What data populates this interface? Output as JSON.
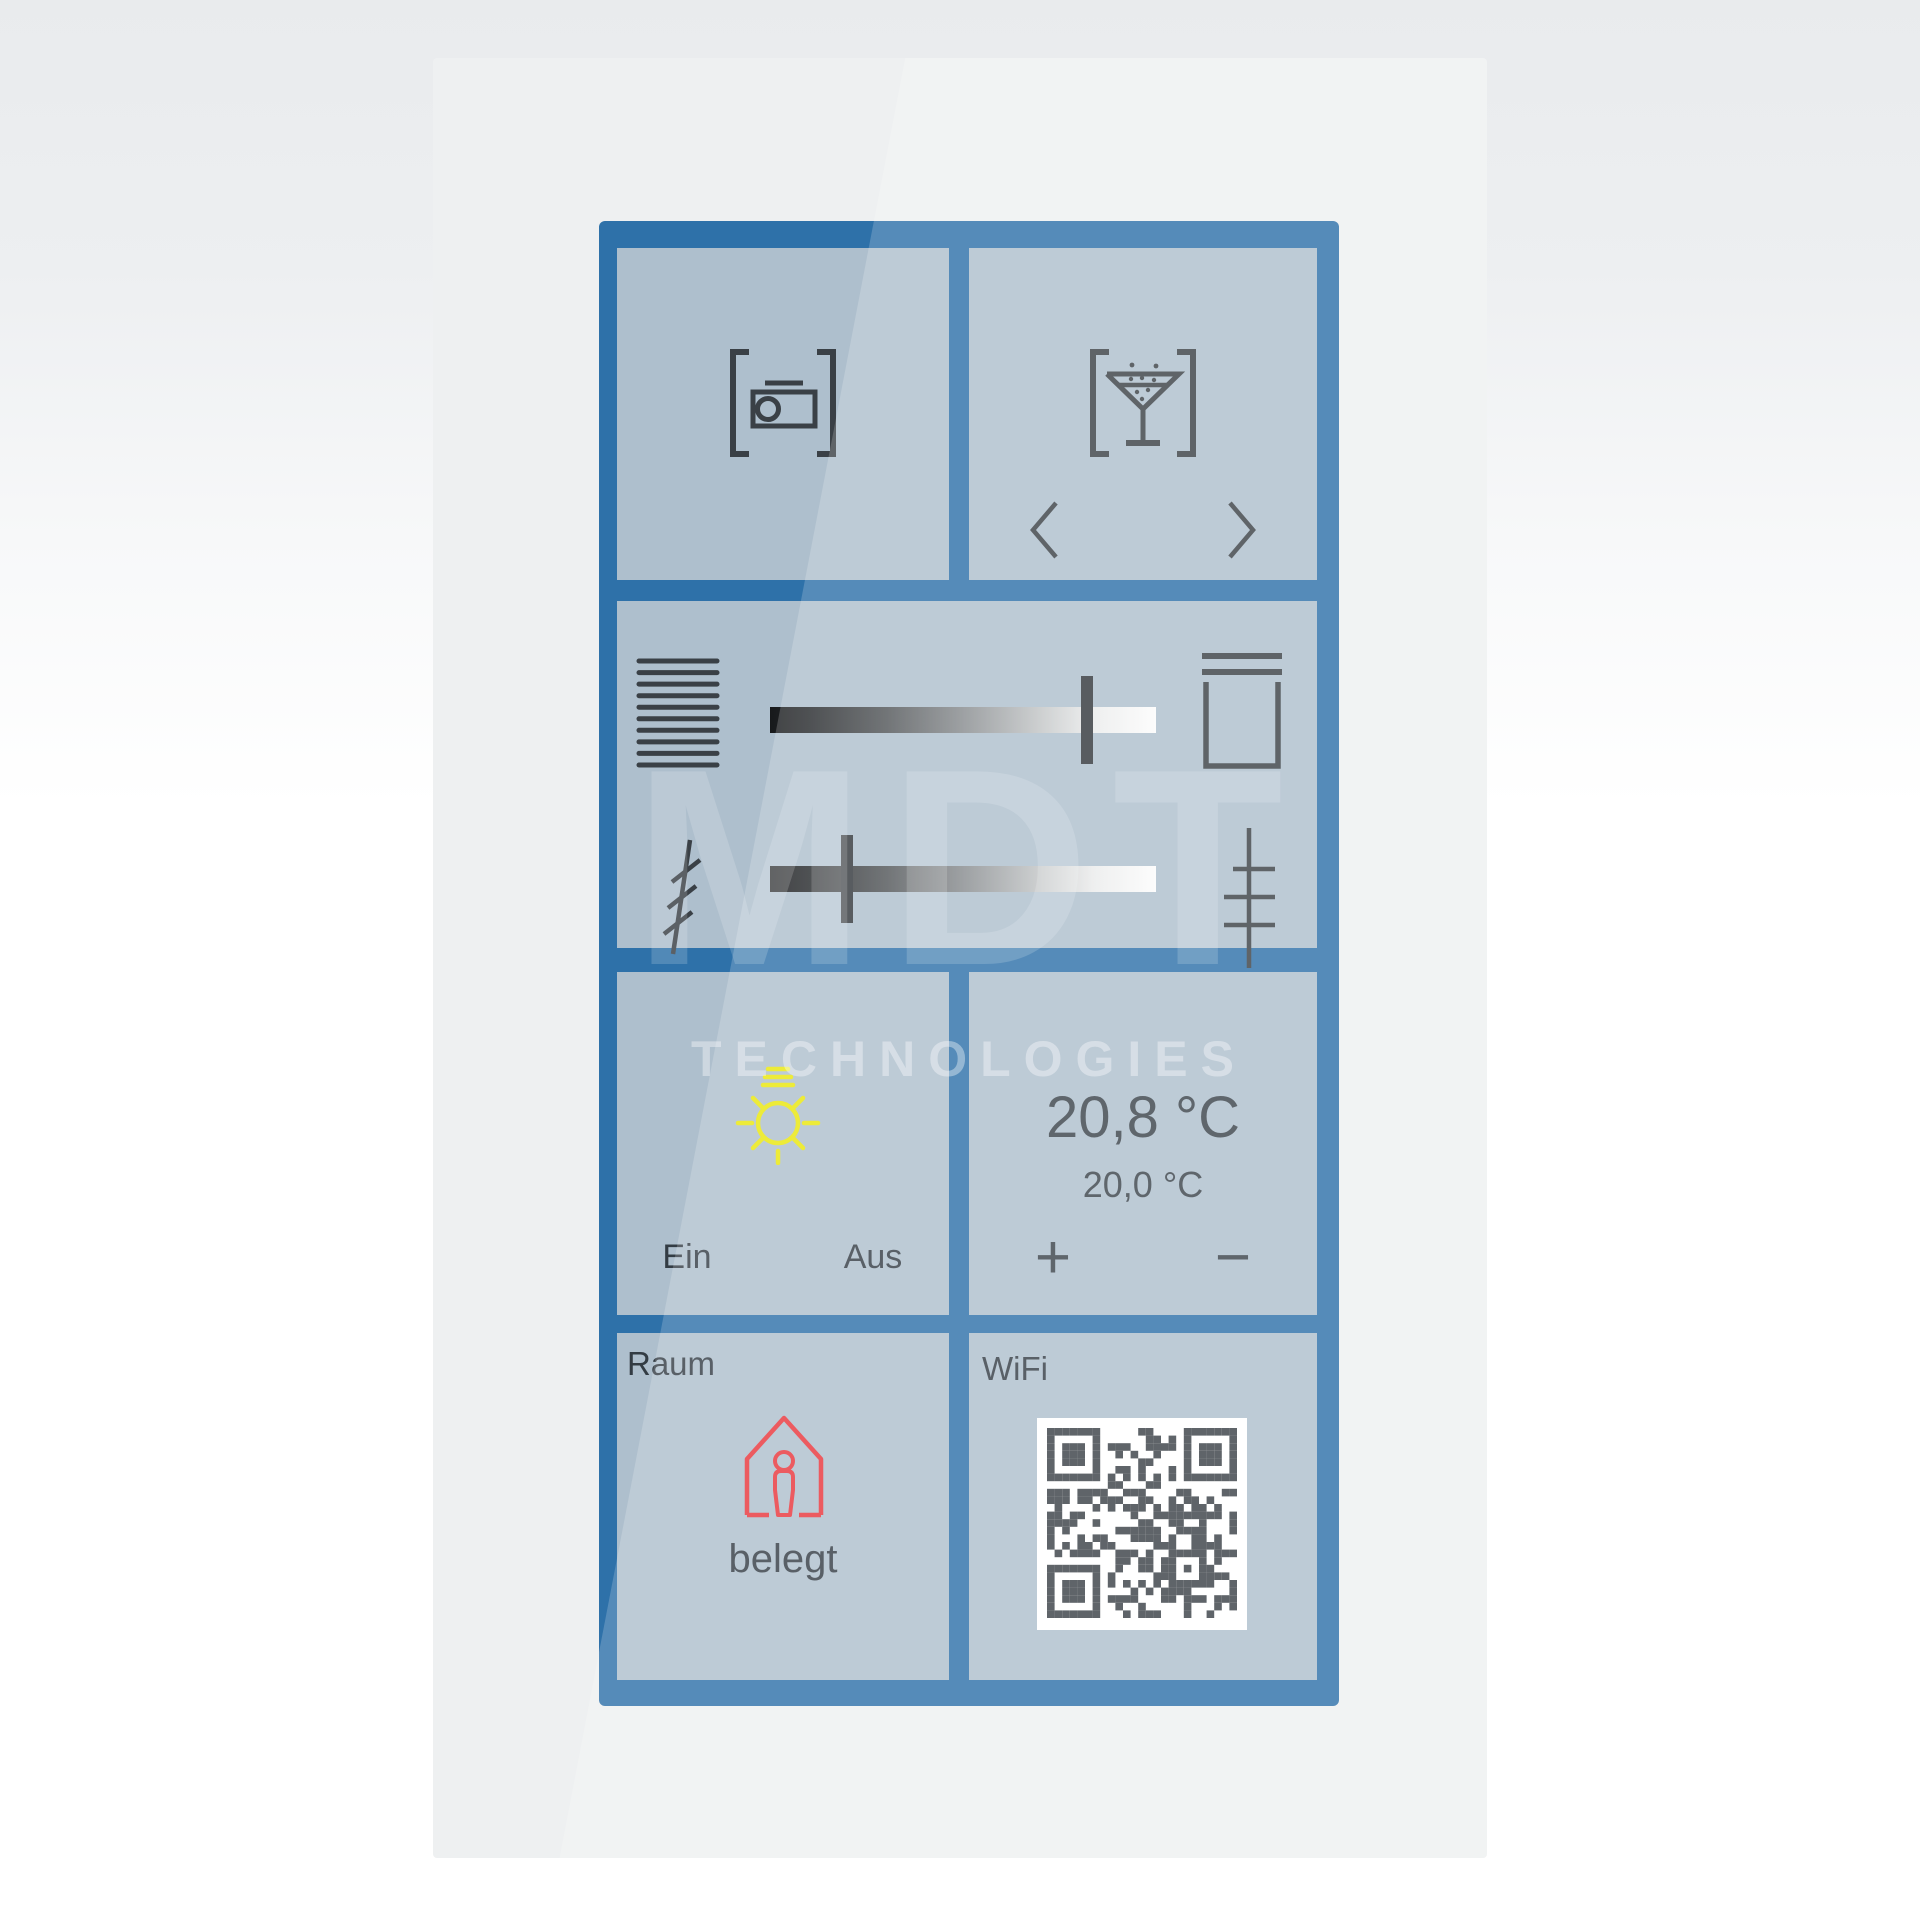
{
  "watermark": {
    "title": "MDT",
    "subtitle": "TECHNOLOGIES"
  },
  "scenes": {
    "projector_tile": {
      "icon": "projector-in-brackets-icon"
    },
    "party_tile": {
      "icon": "cocktail-in-brackets-icon",
      "prev_icon": "chevron-left-icon",
      "next_icon": "chevron-right-icon"
    }
  },
  "shading": {
    "raise_icon": "blinds-closed-icon",
    "open_icon": "shutter-open-icon",
    "position_percent": 82,
    "tilt_left_icon": "slats-tilted-icon",
    "tilt_right_icon": "slats-horizontal-icon",
    "tilt_percent": 20
  },
  "light": {
    "icon": "sun-icon",
    "on_label": "Ein",
    "off_label": "Aus"
  },
  "climate": {
    "current_temperature": "20,8 °C",
    "setpoint_temperature": "20,0 °C",
    "increase_label": "+",
    "decrease_label": "−"
  },
  "room": {
    "label": "Raum",
    "icon": "house-occupied-icon",
    "status": "belegt"
  },
  "wifi": {
    "label": "WiFi",
    "icon": "qr-code"
  },
  "colors": {
    "frame": "#2e71a9",
    "tile": "#aebfcd",
    "panel": "#eef0f1",
    "icon": "#3a4046",
    "sun": "#e9e70c",
    "occupied": "#e8353c",
    "text": "#333c44"
  }
}
